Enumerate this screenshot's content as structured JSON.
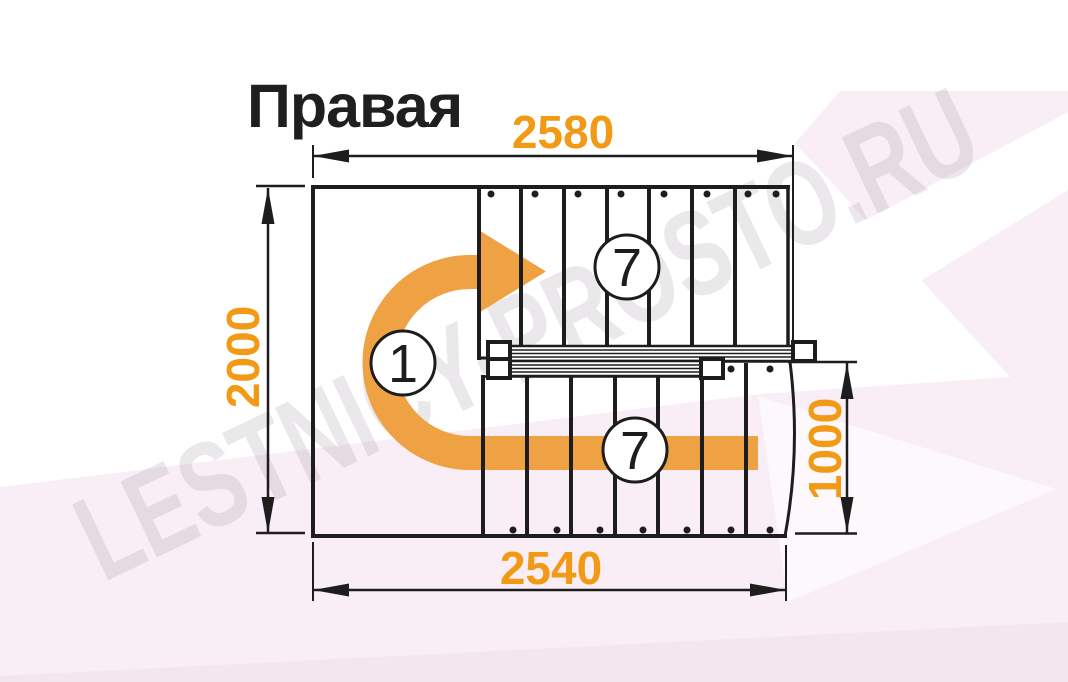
{
  "page": {
    "title": "Правая",
    "watermark": "LESTNICY-PROSTO.RU"
  },
  "dimensions": {
    "top": "2580",
    "left": "2000",
    "bottom": "2540",
    "right": "1000"
  },
  "flights": {
    "upper_steps": "7",
    "lower_steps": "7",
    "start_step": "1"
  },
  "colors": {
    "dimension_orange": "#F29A15",
    "arrow_orange": "#EFA243",
    "line_black": "#1D1D1D",
    "background_pink": "#F8EEF6",
    "watermark_gray": "#8D7F8D"
  }
}
